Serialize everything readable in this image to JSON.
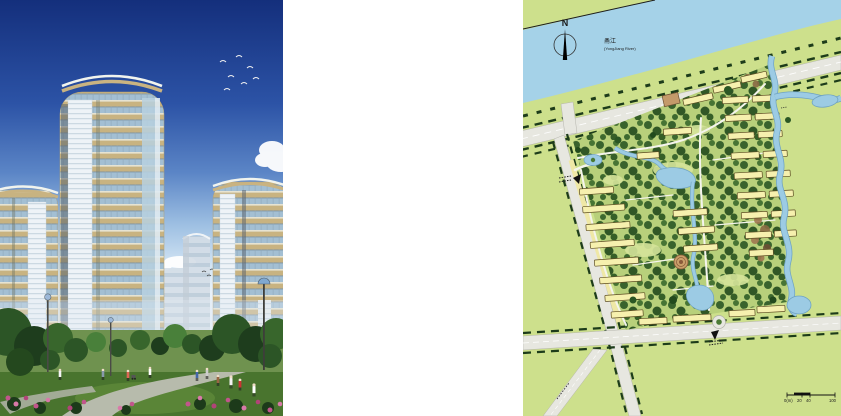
{
  "page": {
    "background_color": "#ffffff"
  },
  "photo_panel": {
    "description": "Architectural rendering of curved tan high-rise apartment towers with rooftop pergola arcs and glass balconies above a landscaped park with paths, flowering shrubs, street lamps and pedestrians under a deep blue sky with a flock of birds and clouds",
    "colors": {
      "sky_top": "#142f7c",
      "sky_horizon": "#e8f1fa",
      "facade_tan": "#c8b381",
      "glass_blue": "#a3bfd3",
      "louver_white": "#eef3f7",
      "foliage_dark": "#24481e",
      "lawn_green": "#49742e",
      "flower_pink": "#c2558c",
      "path_gray": "#b7bbac"
    }
  },
  "map_panel": {
    "north_label": "N",
    "river": {
      "name_zh": "甬江",
      "name_en": "(YongJiang River)"
    },
    "scale_bar": {
      "zero": "0(m)",
      "twenty": "20",
      "forty": "40",
      "hundred": "100"
    },
    "colors": {
      "land_green": "#cde08c",
      "river_blue": "#a5d2e8",
      "site_base_green": "#b8d07b",
      "tree_green_dark": "#2b5724",
      "building_yellow": "#f6f0ae",
      "road_gray": "#e7e7e0",
      "stream_blue": "#9ccbe4",
      "plaza_tan": "#c9a06a"
    },
    "icons": {
      "north_arrow": "compass-needle-icon",
      "entrance_marker": "arrow-icon",
      "street_trees": "dash-marks",
      "scale_bar": "ruler-icon"
    }
  }
}
